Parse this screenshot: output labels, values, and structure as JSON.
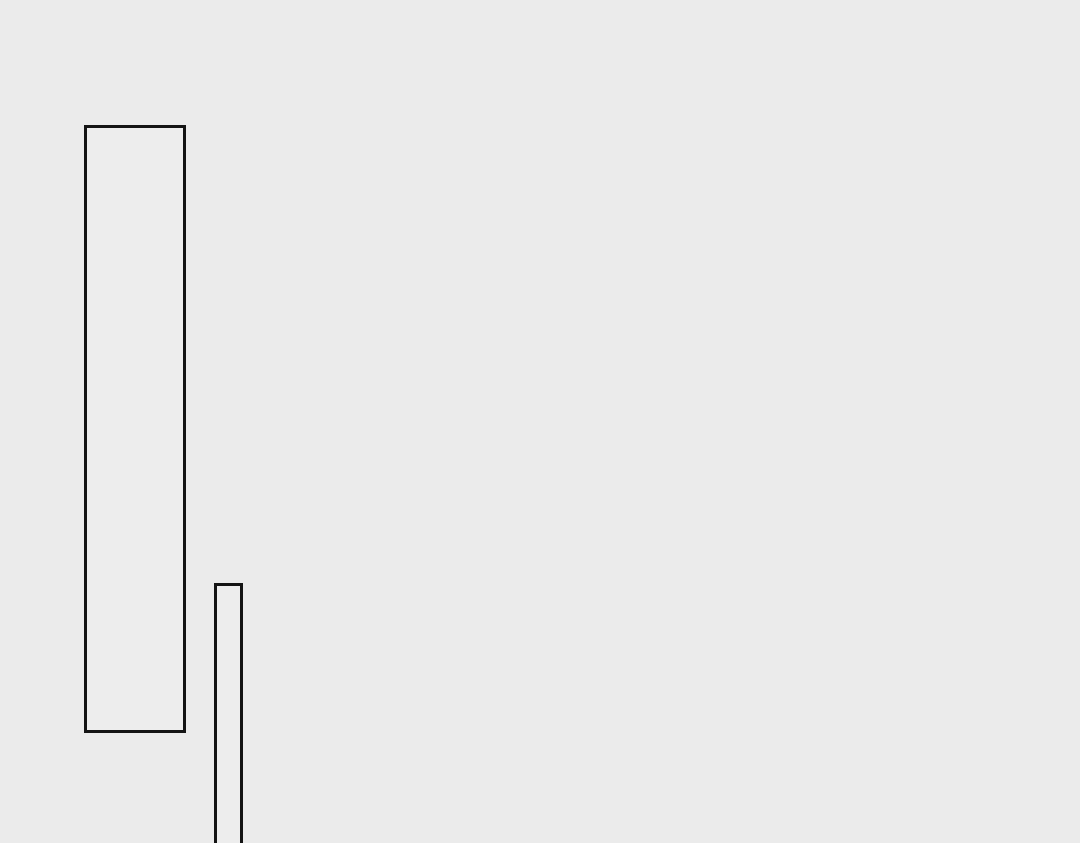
{
  "canvas": {
    "width": 1080,
    "height": 843,
    "background_color": "#ebebeb"
  },
  "shapes": [
    {
      "name": "tall-rectangle",
      "type": "rectangle",
      "x": 84,
      "y": 125,
      "width": 102,
      "height": 608,
      "stroke_color": "#141414",
      "stroke_width": 3.5,
      "fill_color": "#ededed",
      "clipped_at_bottom": false
    },
    {
      "name": "thin-rectangle",
      "type": "rectangle",
      "x": 214,
      "y": 583,
      "width": 29,
      "height": 270,
      "stroke_color": "#141414",
      "stroke_width": 3.5,
      "fill_color": "#ededed",
      "clipped_at_bottom": true
    }
  ]
}
